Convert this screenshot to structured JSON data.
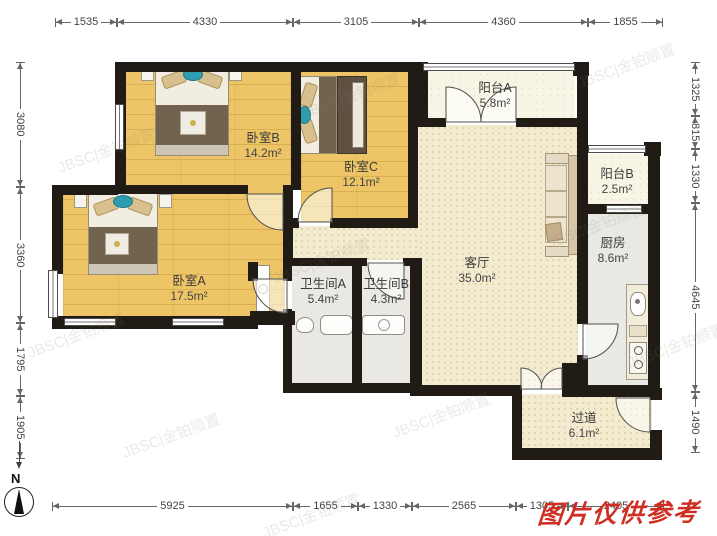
{
  "rooms": [
    {
      "name": "卧室B",
      "area": "14.2m²"
    },
    {
      "name": "卧室C",
      "area": "12.1m²"
    },
    {
      "name": "阳台A",
      "area": "5.8m²"
    },
    {
      "name": "阳台B",
      "area": "2.5m²"
    },
    {
      "name": "厨房",
      "area": "8.6m²"
    },
    {
      "name": "客厅",
      "area": "35.0m²"
    },
    {
      "name": "卧室A",
      "area": "17.5m²"
    },
    {
      "name": "卫生间A",
      "area": "5.4m²"
    },
    {
      "name": "卫生间B",
      "area": "4.3m²"
    },
    {
      "name": "过道",
      "area": "6.1m²"
    }
  ],
  "dimensions_mm": {
    "top": [
      "1535",
      "4330",
      "3105",
      "4360",
      "1855"
    ],
    "left": [
      "3080",
      "3360",
      "1795",
      "1905"
    ],
    "right": [
      "1325",
      "815",
      "1330",
      "4645",
      "1490"
    ],
    "bottom": [
      "5925",
      "1655",
      "1330",
      "2565",
      "1305",
      "2405"
    ]
  },
  "compass": {
    "north_label": "N"
  },
  "watermarks": {
    "reference_note": "图片仅供参考",
    "tiled": "JBSC|金铂顺置"
  },
  "colors": {
    "wall": "#211b15",
    "wood_floor": "#edc567",
    "tile_floor": "#f3ebcf",
    "balcony_floor": "#f9f5e6",
    "bath_floor": "#e9e8e3",
    "reference_red": "#cf2f23"
  }
}
